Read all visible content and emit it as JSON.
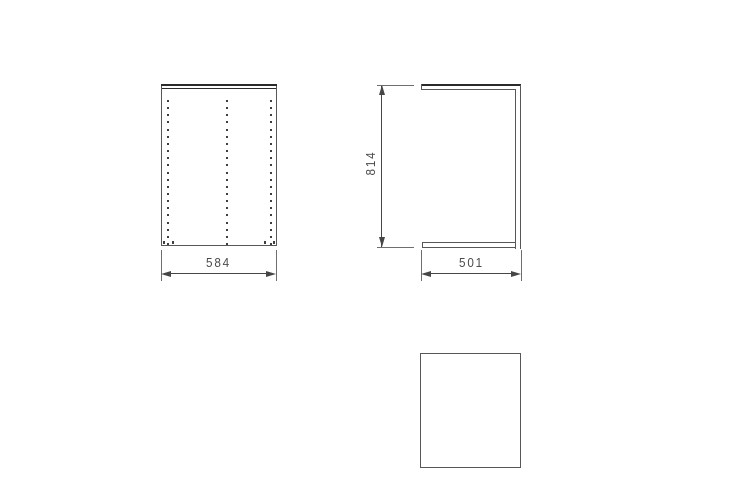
{
  "diagram": {
    "kind": "cabinet-dimension-drawing",
    "dimensions": {
      "front_width": "584",
      "side_height": "814",
      "side_depth": "501"
    },
    "front_view": {
      "drill_pattern": {
        "columns_x": [
          6.5,
          65.5,
          110
        ],
        "rows": 21,
        "start_y": 16,
        "spacing_y": 7.15,
        "bottom_marks_x": [
          2.5,
          11.5,
          104,
          112.5
        ]
      }
    },
    "colors": {
      "background": "#ffffff",
      "outline": "#575757",
      "outline_dark": "#2b2b2b",
      "dimension_line": "#464646",
      "extension_line": "#6e6e6e",
      "hole_dot": "#3f3f3f",
      "text": "#4a4a4a"
    }
  }
}
